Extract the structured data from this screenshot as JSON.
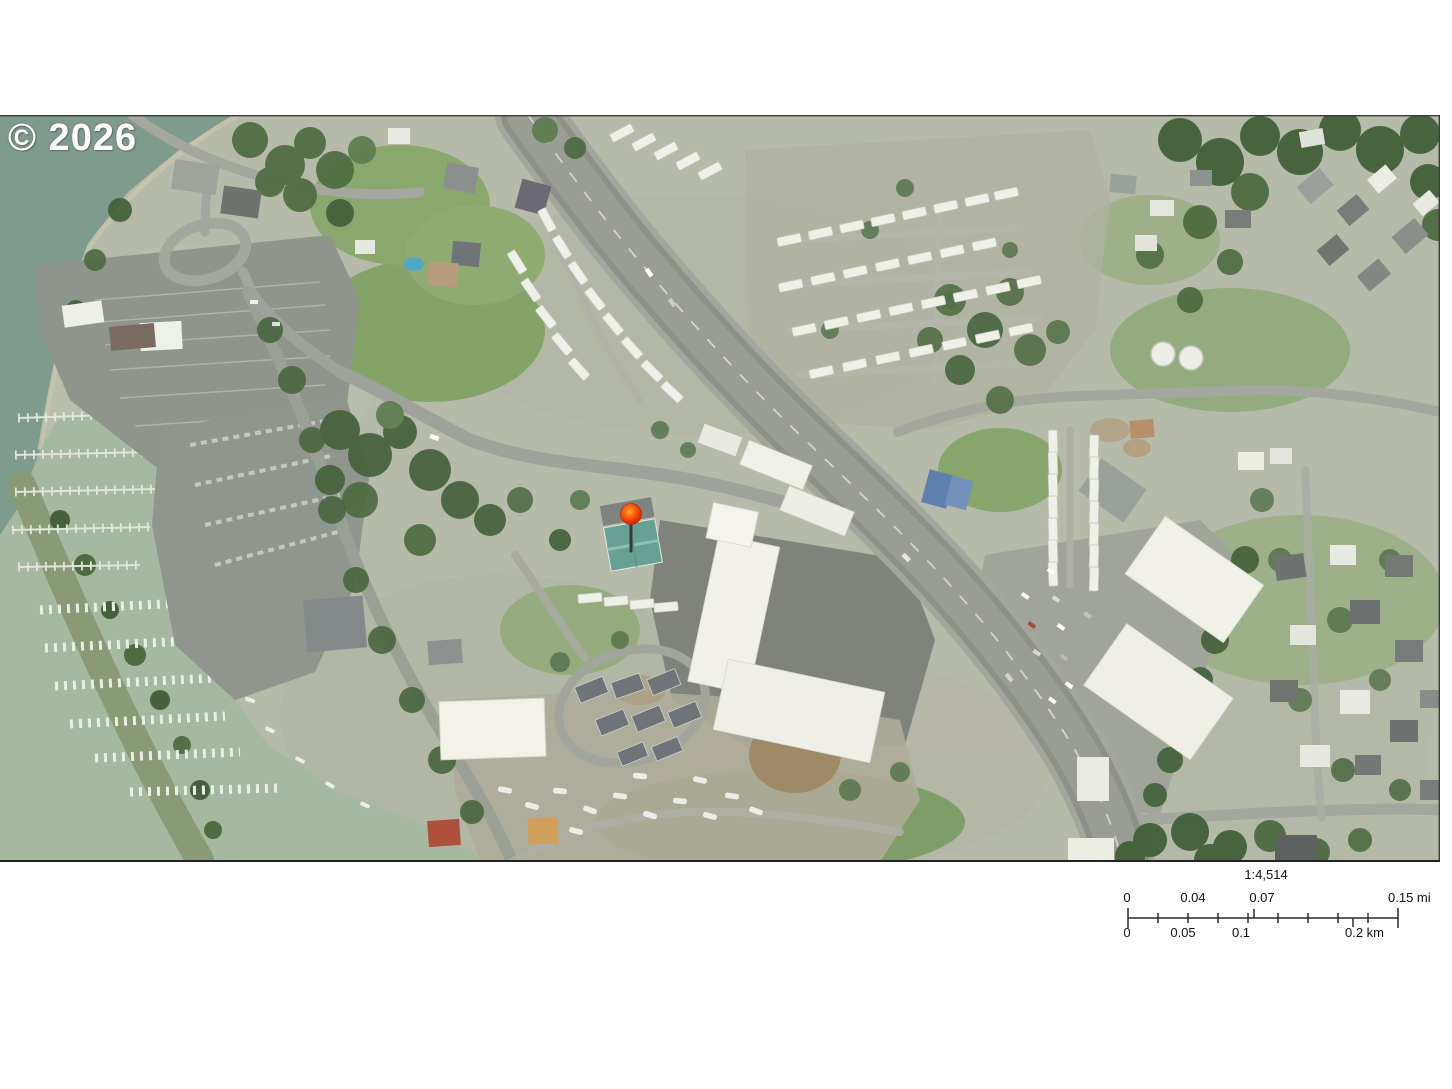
{
  "map": {
    "copyright_text": "© 2026",
    "marker_color": "#e83400",
    "marker_highlight": "#ffb347",
    "subject_roof_color": "#69a094"
  },
  "scale_bar": {
    "ratio_label": "1:4,514",
    "miles": {
      "tick_labels": [
        "0",
        "0.04",
        "0.07"
      ],
      "end_label": "0.15 mi"
    },
    "kilometers": {
      "tick_labels": [
        "0",
        "0.05",
        "0.1"
      ],
      "end_label": "0.2 km"
    }
  }
}
